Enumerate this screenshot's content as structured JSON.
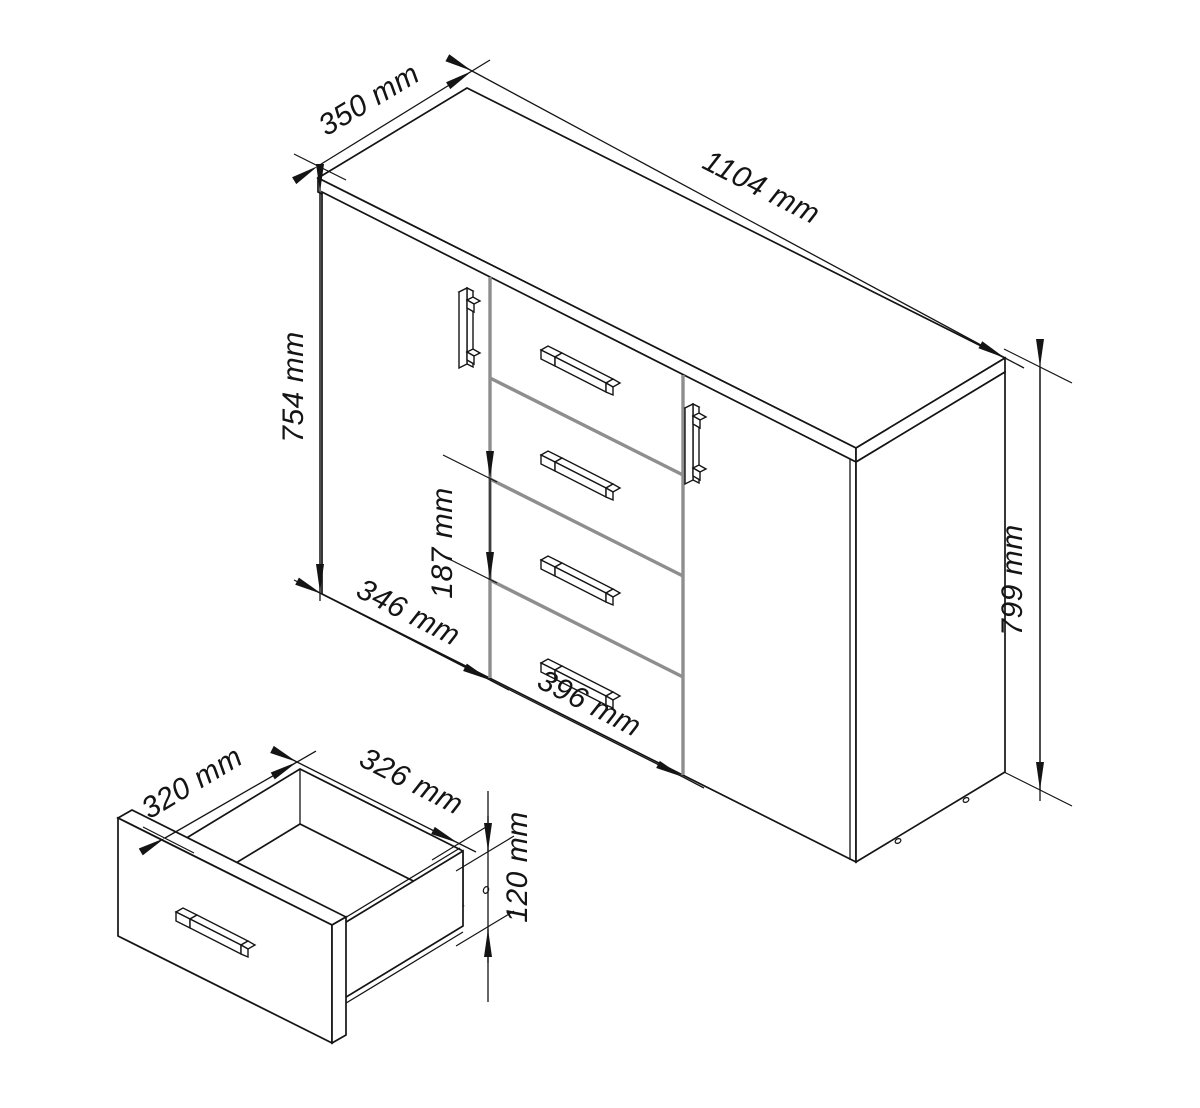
{
  "colors": {
    "background": "#ffffff",
    "line": "#141414",
    "divider_gray": "#8e8e8e",
    "text": "#141414"
  },
  "main_view": {
    "dimensions": {
      "depth": {
        "label": "350 mm",
        "value_mm": 350
      },
      "width": {
        "label": "1104 mm",
        "value_mm": 1104
      },
      "door_height": {
        "label": "754 mm",
        "value_mm": 754
      },
      "drawer_front_height": {
        "label": "187 mm",
        "value_mm": 187
      },
      "door_width": {
        "label": "346 mm",
        "value_mm": 346
      },
      "drawer_width": {
        "label": "396 mm",
        "value_mm": 396
      },
      "height": {
        "label": "799 mm",
        "value_mm": 799
      }
    }
  },
  "detail_view": {
    "dimensions": {
      "inner_depth": {
        "label": "320 mm",
        "value_mm": 320
      },
      "inner_width": {
        "label": "326 mm",
        "value_mm": 326
      },
      "side_height": {
        "label": "120 mm",
        "value_mm": 120
      }
    }
  }
}
